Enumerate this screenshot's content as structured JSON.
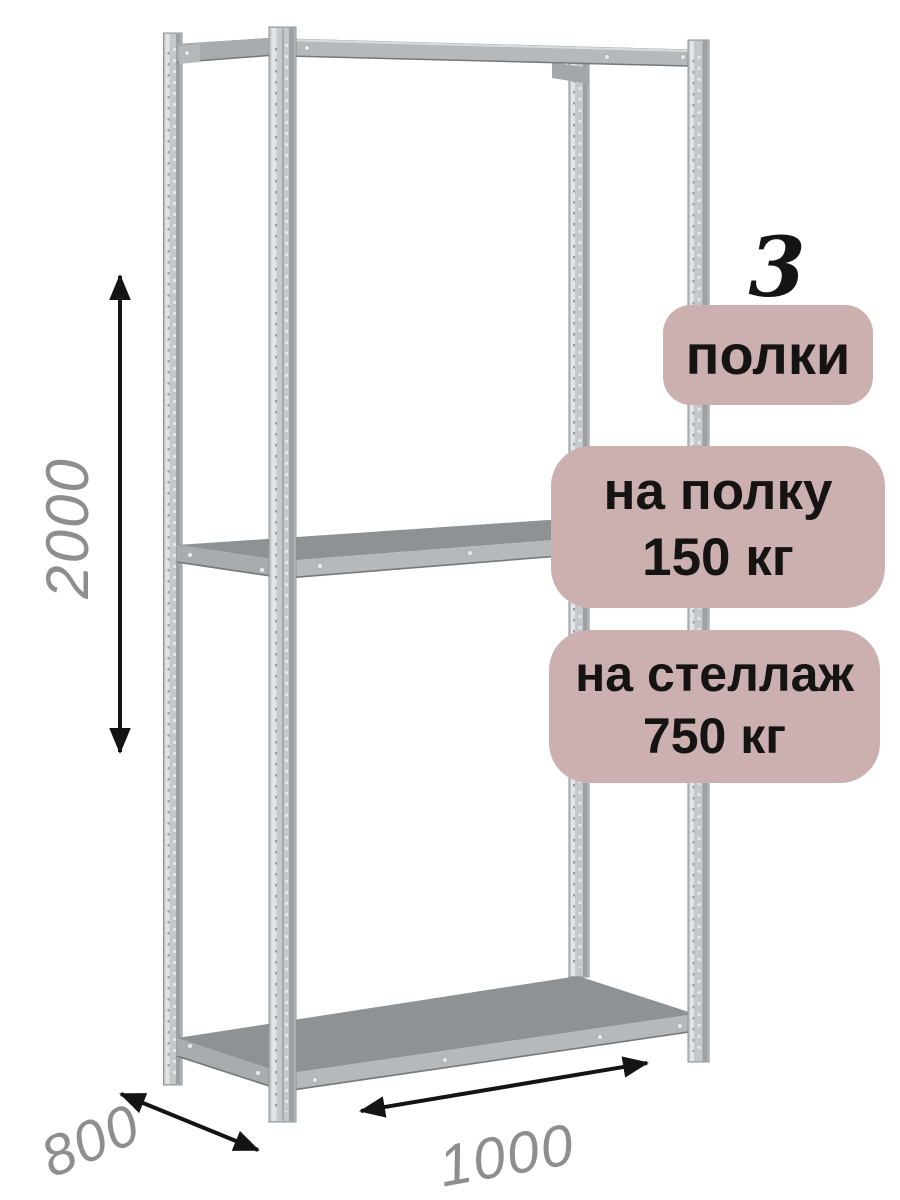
{
  "palette": {
    "bg": "#ffffff",
    "badge-bg": "#ccb0b0",
    "badge-text": "#161412",
    "dim-text": "#8e8e8e",
    "arrow": "#141414",
    "post-base": "#c4c8ca",
    "post-light": "#e2e5e6",
    "post-dark": "#9aa0a3",
    "post-edge": "#8b9194",
    "shelf-top": "#8d9294",
    "shelf-front": "#b5b9bb",
    "shelf-side": "#a7acae",
    "beam-back": "#a2a7a9",
    "rivet": "#e4e6e7",
    "shelf-line": "#75797c",
    "beam-hi": "#d9dcdd"
  },
  "illustration": {
    "subject": "metal boltless shelving rack, 3D line drawing, 4 perforated posts, 3 shelves",
    "shelf_count": 3
  },
  "dimensions": {
    "height_mm": "2000",
    "depth_mm": "800",
    "width_mm": "1000"
  },
  "badges": {
    "count_number": "3",
    "count_label": "полки",
    "per_shelf_line1": "на полку",
    "per_shelf_line2": "150 кг",
    "per_rack_line1": "на стеллаж",
    "per_rack_line2": "750 кг"
  }
}
